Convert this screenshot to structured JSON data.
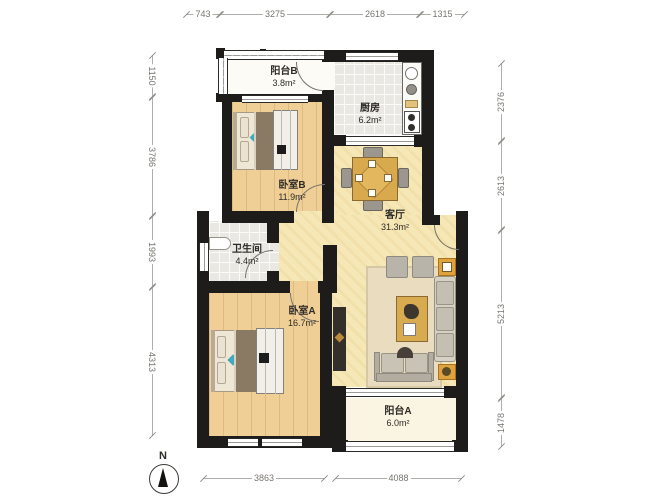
{
  "compass": {
    "label": "N"
  },
  "rooms": [
    {
      "name": "阳台B",
      "area": "3.8m²"
    },
    {
      "name": "厨房",
      "area": "6.2m²"
    },
    {
      "name": "卧室B",
      "area": "11.9m²"
    },
    {
      "name": "客厅",
      "area": "31.3m²"
    },
    {
      "name": "卫生间",
      "area": "4.4m²"
    },
    {
      "name": "卧室A",
      "area": "16.7m²"
    },
    {
      "name": "阳台A",
      "area": "6.0m²"
    }
  ],
  "dimensions": {
    "top": [
      "743",
      "3275",
      "2618",
      "1315"
    ],
    "left": [
      "1150",
      "3786",
      "1993",
      "4313"
    ],
    "right": [
      "2376",
      "2613",
      "5213",
      "1478"
    ],
    "bottom": [
      "3863",
      "4088"
    ]
  },
  "colors": {
    "wall": "#1d1c1a",
    "wood_floor": "#efcf96",
    "living_floor": "#f6e7b6",
    "tile_floor": "#e9e8e3",
    "balcony_floor": "#faf4e2",
    "accent_orange": "#dfa23f",
    "accent_teal": "#3fa9bf",
    "bed_blanket": "#8a7a64",
    "dim_text": "#77756f"
  }
}
